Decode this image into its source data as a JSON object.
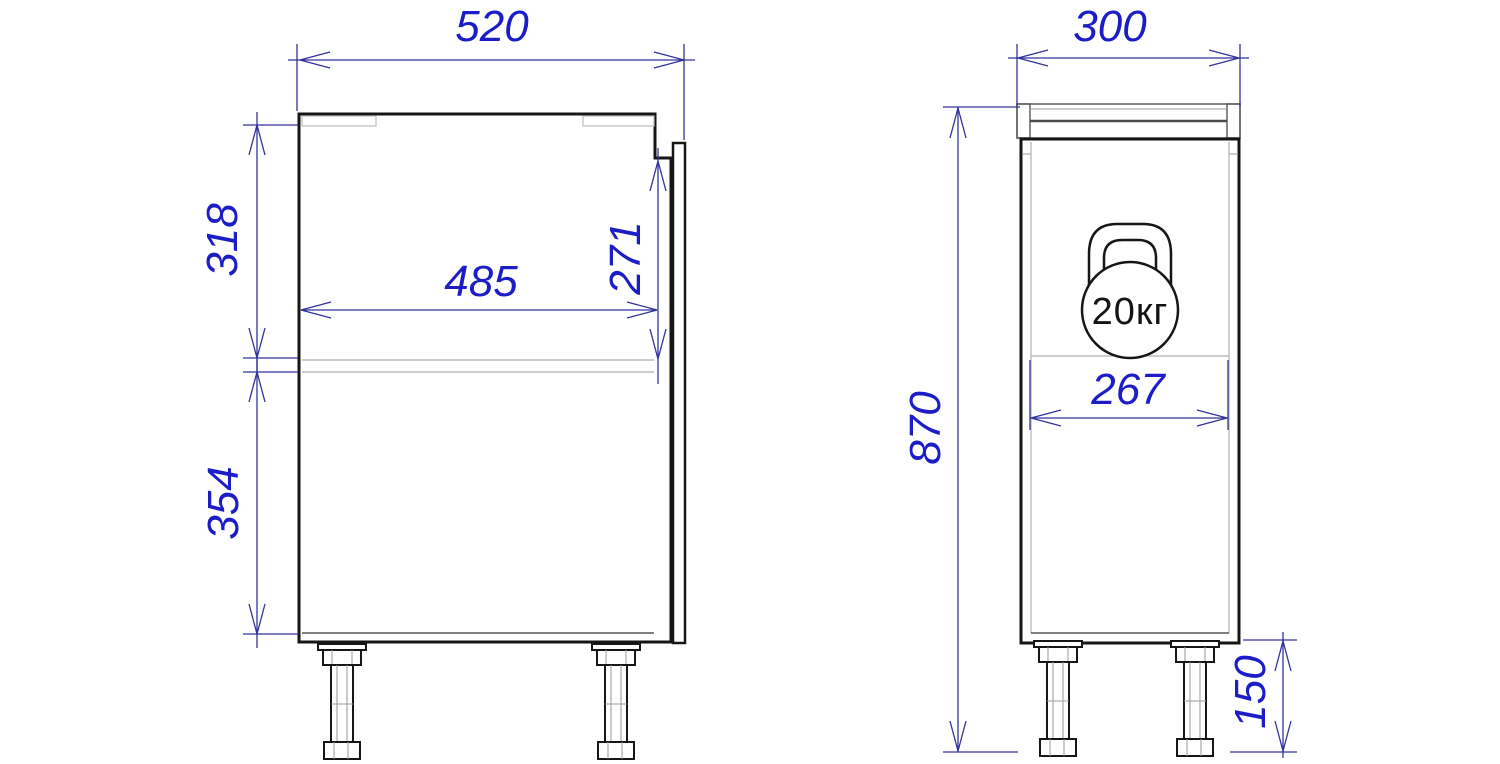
{
  "drawing": {
    "type": "furniture technical drawing, two orthographic views of a base cabinet on adjustable legs",
    "colors": {
      "background": "#ffffff",
      "outline": "#161616",
      "light_line": "#bcbcbc",
      "dimension_line": "#32329b",
      "dimension_text": "#1d1dc8",
      "badge_text": "#141414"
    }
  },
  "front_view": {
    "label": "side section view",
    "dim_overall_depth": "520",
    "dim_inner_width": "485",
    "dim_upper_height": "318",
    "dim_front_top_height": "271",
    "dim_lower_height": "354"
  },
  "side_view": {
    "label": "front view",
    "dim_top_width": "300",
    "dim_overall_height": "870",
    "dim_inner_width": "267",
    "dim_leg_height": "150",
    "load_badge": "20кг"
  }
}
